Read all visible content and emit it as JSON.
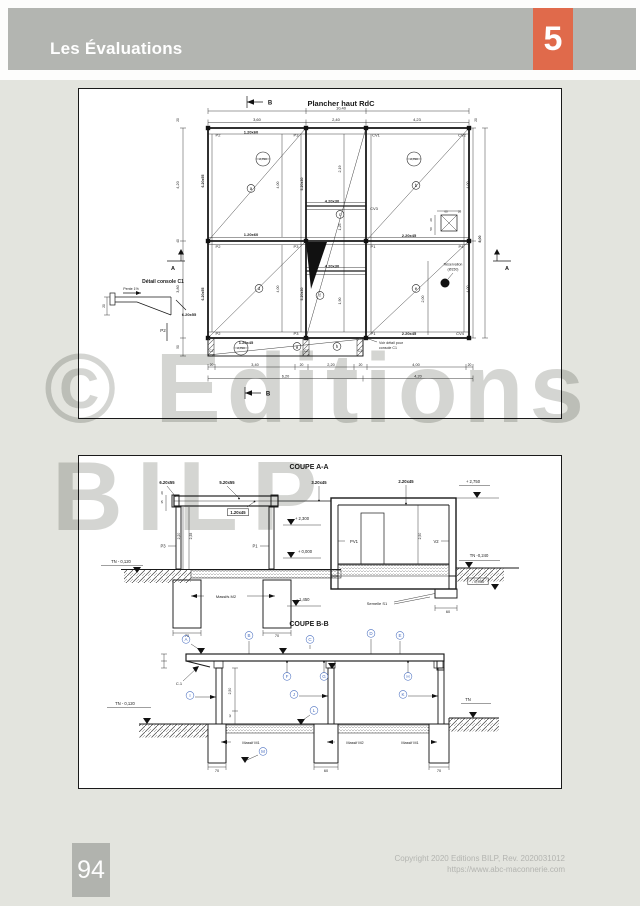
{
  "header": {
    "title": "Les Évaluations",
    "chapter": "5"
  },
  "watermark": {
    "line1": "© Editions",
    "line2": "BILP"
  },
  "footer": {
    "page_number": "94",
    "copyright_line1": "Copyright 2020 Editions BILP, Rev. 2020031012",
    "copyright_line2": "https://www.abc-maconnerie.com"
  },
  "colors": {
    "header_bar": "#b3b5b1",
    "chapter_orange": "#e06a4b",
    "page_bg": "#e3e4de",
    "panel_bg": "#ffffff",
    "line": "#1a1a1a",
    "callout_blue": "#4a6fc0",
    "watermark_gray": "#c6c7c3"
  },
  "plan": {
    "labels": [
      {
        "t": "Plancher haut RdC",
        "x": 262,
        "y": 17,
        "fs": 7.5,
        "b": 1
      },
      {
        "t": "B",
        "x": 191,
        "y": 15.5,
        "fs": 6,
        "b": 1
      },
      {
        "t": "10,40",
        "x": 262,
        "y": 20.5,
        "fs": 4
      },
      {
        "t": "3,60",
        "x": 178,
        "y": 32,
        "fs": 4
      },
      {
        "t": "2,40",
        "x": 257,
        "y": 32,
        "fs": 4
      },
      {
        "t": "4,23",
        "x": 338,
        "y": 32,
        "fs": 4
      },
      {
        "t": "20",
        "x": 100,
        "y": 31,
        "rot": -90,
        "fs": 3.2
      },
      {
        "t": "20",
        "x": 398,
        "y": 31,
        "rot": -90,
        "fs": 3.2
      },
      {
        "t": "4,20",
        "x": 100,
        "y": 96,
        "rot": -90,
        "fs": 3.8
      },
      {
        "t": "40",
        "x": 100,
        "y": 152,
        "rot": -90,
        "fs": 3.2
      },
      {
        "t": "3,80",
        "x": 100,
        "y": 200,
        "rot": -90,
        "fs": 3.8
      },
      {
        "t": "50",
        "x": 100,
        "y": 258,
        "rot": -90,
        "fs": 3.2
      },
      {
        "t": "6.20x55",
        "x": 125,
        "y": 92,
        "rot": -90,
        "fs": 3.6,
        "b": 1
      },
      {
        "t": "6.20x55",
        "x": 125,
        "y": 205,
        "rot": -90,
        "fs": 3.6,
        "b": 1
      },
      {
        "t": "5.20x30",
        "x": 224,
        "y": 95,
        "rot": -90,
        "fs": 3.6,
        "b": 1
      },
      {
        "t": "5.20x30",
        "x": 224,
        "y": 205,
        "rot": -90,
        "fs": 3.6,
        "b": 1
      },
      {
        "t": "P2",
        "x": 139,
        "y": 47.5,
        "fs": 4
      },
      {
        "t": "P3",
        "x": 217,
        "y": 47.5,
        "fs": 4
      },
      {
        "t": "CV1",
        "x": 297,
        "y": 47.5,
        "fs": 4
      },
      {
        "t": "CV2",
        "x": 383,
        "y": 47.5,
        "fs": 4
      },
      {
        "t": "1.20x60",
        "x": 172,
        "y": 44.5,
        "fs": 4,
        "b": 1
      },
      {
        "t": "1.20x60",
        "x": 172,
        "y": 147,
        "fs": 4,
        "b": 1
      },
      {
        "t": "1.20x45",
        "x": 167,
        "y": 255,
        "fs": 4,
        "b": 1
      },
      {
        "t": "P2",
        "x": 139,
        "y": 159,
        "fs": 4
      },
      {
        "t": "P3",
        "x": 217,
        "y": 159,
        "fs": 4
      },
      {
        "t": "P1",
        "x": 294,
        "y": 159,
        "fs": 4
      },
      {
        "t": "P4",
        "x": 382,
        "y": 159,
        "fs": 4
      },
      {
        "t": "P2",
        "x": 139,
        "y": 246,
        "fs": 4
      },
      {
        "t": "P3",
        "x": 217,
        "y": 246,
        "fs": 4
      },
      {
        "t": "P1",
        "x": 294,
        "y": 246,
        "fs": 4
      },
      {
        "t": "CV4",
        "x": 381,
        "y": 246,
        "fs": 4
      },
      {
        "t": "2.20x45",
        "x": 330,
        "y": 148,
        "fs": 4,
        "b": 1
      },
      {
        "t": "2.20x45",
        "x": 330,
        "y": 246,
        "fs": 4,
        "b": 1
      },
      {
        "t": "4.20x30",
        "x": 253,
        "y": 113.5,
        "fs": 4,
        "b": 1
      },
      {
        "t": "4.20x30",
        "x": 253,
        "y": 178.5,
        "fs": 4,
        "b": 1
      },
      {
        "t": "CV3",
        "x": 295,
        "y": 121,
        "fs": 4
      },
      {
        "t": "2,19",
        "x": 262,
        "y": 80,
        "rot": -90,
        "fs": 3.6
      },
      {
        "t": "1,25",
        "x": 262,
        "y": 138,
        "rot": -90,
        "fs": 3.6
      },
      {
        "t": "1,90",
        "x": 262,
        "y": 212,
        "rot": -90,
        "fs": 3.6
      },
      {
        "t": "4,00",
        "x": 200,
        "y": 96,
        "rot": -90,
        "fs": 3.6
      },
      {
        "t": "4,00",
        "x": 200,
        "y": 200,
        "rot": -90,
        "fs": 3.6
      },
      {
        "t": "4,00",
        "x": 390,
        "y": 96,
        "rot": -90,
        "fs": 3.6
      },
      {
        "t": "4,00",
        "x": 390,
        "y": 200,
        "rot": -90,
        "fs": 3.6
      },
      {
        "t": "8,00",
        "x": 402,
        "y": 150,
        "rot": -90,
        "fs": 3.6,
        "b": 1
      },
      {
        "t": "2,00",
        "x": 345,
        "y": 210,
        "rot": -90,
        "fs": 3.6
      },
      {
        "t": "a",
        "x": 172,
        "y": 101,
        "circ": 1
      },
      {
        "t": "b",
        "x": 337,
        "y": 98,
        "circ": 1
      },
      {
        "t": "c",
        "x": 261,
        "y": 127,
        "circ": 1
      },
      {
        "t": "d",
        "x": 180,
        "y": 201,
        "circ": 1
      },
      {
        "t": "e",
        "x": 337,
        "y": 201,
        "circ": 1
      },
      {
        "t": "f",
        "x": 241,
        "y": 208,
        "circ": 1
      },
      {
        "t": "g",
        "x": 218,
        "y": 259,
        "circ": 1
      },
      {
        "t": "h",
        "x": 258,
        "y": 259,
        "circ": 1
      },
      {
        "t": "2,790",
        "x": 184,
        "y": 71,
        "circ": 1,
        "r": 7,
        "fs": 3
      },
      {
        "t": "2,790",
        "x": 335,
        "y": 71,
        "circ": 1,
        "r": 7,
        "fs": 3
      },
      {
        "t": "2,790",
        "x": 162,
        "y": 260,
        "circ": 1,
        "r": 7,
        "fs": 3
      },
      {
        "t": "60",
        "x": 367,
        "y": 123.5,
        "fs": 3
      },
      {
        "t": "20",
        "x": 380.5,
        "y": 123.5,
        "fs": 3
      },
      {
        "t": "20",
        "x": 353,
        "y": 131,
        "rot": -90,
        "fs": 3
      },
      {
        "t": "50",
        "x": 353,
        "y": 140,
        "rot": -90,
        "fs": 3
      },
      {
        "t": "Réservation",
        "x": 374,
        "y": 176.5,
        "fs": 3.5
      },
      {
        "t": "(Ø150)",
        "x": 374,
        "y": 181.5,
        "fs": 3.5
      },
      {
        "t": "A",
        "x": 94,
        "y": 181,
        "fs": 5.5,
        "b": 1
      },
      {
        "t": "A",
        "x": 428,
        "y": 181,
        "fs": 5.5,
        "b": 1
      },
      {
        "t": "Détail console C1",
        "x": 84,
        "y": 194,
        "fs": 5,
        "b": 1
      },
      {
        "t": "Pente 1%",
        "x": 52,
        "y": 201,
        "fs": 3.6
      },
      {
        "t": "20",
        "x": 26,
        "y": 217,
        "rot": -90,
        "fs": 3.2
      },
      {
        "t": "6.20x55",
        "x": 110,
        "y": 227,
        "fs": 4,
        "b": 1
      },
      {
        "t": "P2",
        "x": 84,
        "y": 243,
        "fs": 4.5
      },
      {
        "t": "C1",
        "x": 132,
        "y": 263,
        "fs": 3.2
      },
      {
        "t": "C2",
        "x": 227,
        "y": 263,
        "fs": 3.2
      },
      {
        "t": "C3",
        "x": 281,
        "y": 263,
        "fs": 3.2
      },
      {
        "t": "Voir détail pour",
        "x": 300,
        "y": 255,
        "fs": 3.6,
        "a": "s"
      },
      {
        "t": "console C1",
        "x": 300,
        "y": 260,
        "fs": 3.6,
        "a": "s"
      },
      {
        "t": "20",
        "x": 132.5,
        "y": 277,
        "fs": 3.4
      },
      {
        "t": "3,40",
        "x": 176,
        "y": 277,
        "fs": 3.8
      },
      {
        "t": "20",
        "x": 222.5,
        "y": 277,
        "fs": 3.4
      },
      {
        "t": "2,20",
        "x": 252,
        "y": 277,
        "fs": 3.8
      },
      {
        "t": "20",
        "x": 281.5,
        "y": 277,
        "fs": 3.4
      },
      {
        "t": "4,00",
        "x": 337,
        "y": 277,
        "fs": 3.8
      },
      {
        "t": "20",
        "x": 390.5,
        "y": 277,
        "fs": 3.4
      },
      {
        "t": "6,20",
        "x": 206.5,
        "y": 288.5,
        "fs": 3.8
      },
      {
        "t": "4,20",
        "x": 339,
        "y": 288.5,
        "fs": 3.8
      },
      {
        "t": "B",
        "x": 189,
        "y": 306.5,
        "fs": 6,
        "b": 1
      }
    ]
  },
  "coupe_a": {
    "labels": [
      {
        "t": "COUPE A-A",
        "x": 230,
        "y": 13,
        "fs": 7,
        "b": 1
      },
      {
        "t": "6.20x55",
        "x": 88,
        "y": 28,
        "fs": 4.2,
        "b": 1
      },
      {
        "t": "5.20x55",
        "x": 148,
        "y": 28,
        "fs": 4.2,
        "b": 1
      },
      {
        "t": "3.20x45",
        "x": 240,
        "y": 28,
        "fs": 4.2,
        "b": 1
      },
      {
        "t": "2.20x45",
        "x": 327,
        "y": 27,
        "fs": 4.2,
        "b": 1
      },
      {
        "t": "+ 2,750",
        "x": 394,
        "y": 27,
        "fs": 4.2
      },
      {
        "t": "1.20x45",
        "x": 159,
        "y": 58,
        "fs": 4.2,
        "b": 1,
        "box": 1
      },
      {
        "t": "+ 2,300",
        "x": 223,
        "y": 64,
        "fs": 4.2
      },
      {
        "t": "20",
        "x": 84,
        "y": 37,
        "rot": -90,
        "fs": 3
      },
      {
        "t": "35",
        "x": 84,
        "y": 46,
        "rot": -90,
        "fs": 3
      },
      {
        "t": "2,20",
        "x": 101,
        "y": 80,
        "rot": -90,
        "fs": 3.4
      },
      {
        "t": "2,35",
        "x": 113,
        "y": 80,
        "rot": -90,
        "fs": 3.4
      },
      {
        "t": "P3",
        "x": 84,
        "y": 91.5,
        "fs": 4.2
      },
      {
        "t": "P1",
        "x": 176,
        "y": 91.5,
        "fs": 4.2
      },
      {
        "t": "PV1",
        "x": 275,
        "y": 87,
        "fs": 4.2
      },
      {
        "t": "V2",
        "x": 357,
        "y": 87,
        "fs": 4.2
      },
      {
        "t": "2,50",
        "x": 342,
        "y": 80,
        "rot": -90,
        "fs": 3.4
      },
      {
        "t": "TN - 0,120",
        "x": 42,
        "y": 107,
        "fs": 4.2
      },
      {
        "t": "+ 0,000",
        "x": 226,
        "y": 97,
        "fs": 4.2
      },
      {
        "t": "Massifs M2",
        "x": 147,
        "y": 142,
        "fs": 4
      },
      {
        "t": "- 1,450",
        "x": 224,
        "y": 145,
        "fs": 4.2
      },
      {
        "t": "70",
        "x": 108,
        "y": 181,
        "fs": 3.8
      },
      {
        "t": "70",
        "x": 198,
        "y": 181,
        "fs": 3.8
      },
      {
        "t": "TN -0,240",
        "x": 400,
        "y": 101,
        "fs": 4.2
      },
      {
        "t": "- 0,950",
        "x": 399,
        "y": 127,
        "fs": 4,
        "box": 1
      },
      {
        "t": "Semelle S1",
        "x": 298,
        "y": 149,
        "fs": 4
      },
      {
        "t": "60",
        "x": 369,
        "y": 157,
        "fs": 3.8
      }
    ]
  },
  "coupe_b": {
    "labels": [
      {
        "t": "COUPE B-B",
        "x": 230,
        "y": 170,
        "fs": 7,
        "b": 1
      },
      {
        "t": "A",
        "x": 107,
        "y": 185,
        "circ": 1,
        "col": "b"
      },
      {
        "t": "B",
        "x": 170,
        "y": 181,
        "circ": 1,
        "col": "b"
      },
      {
        "t": "C",
        "x": 231,
        "y": 185,
        "circ": 1,
        "col": "b"
      },
      {
        "t": "D",
        "x": 292,
        "y": 179,
        "circ": 1,
        "col": "b"
      },
      {
        "t": "E",
        "x": 321,
        "y": 181,
        "circ": 1,
        "col": "b"
      },
      {
        "t": "F",
        "x": 208,
        "y": 222,
        "circ": 1,
        "col": "b"
      },
      {
        "t": "G",
        "x": 245,
        "y": 222,
        "circ": 1,
        "col": "b"
      },
      {
        "t": "H",
        "x": 329,
        "y": 222,
        "circ": 1,
        "col": "b"
      },
      {
        "t": "I",
        "x": 111,
        "y": 241,
        "circ": 1,
        "col": "b"
      },
      {
        "t": "J",
        "x": 215,
        "y": 240,
        "circ": 1,
        "col": "b"
      },
      {
        "t": "K",
        "x": 324,
        "y": 240,
        "circ": 1,
        "col": "b"
      },
      {
        "t": "L",
        "x": 235,
        "y": 256,
        "circ": 1,
        "col": "b"
      },
      {
        "t": "M",
        "x": 184,
        "y": 297,
        "circ": 1,
        "col": "b"
      },
      {
        "t": "C.1",
        "x": 100,
        "y": 229,
        "fs": 4
      },
      {
        "t": "TN - 0,120",
        "x": 46,
        "y": 249,
        "fs": 4.2
      },
      {
        "t": "TN",
        "x": 389,
        "y": 245,
        "fs": 4.2
      },
      {
        "t": "2,50",
        "x": 152,
        "y": 235,
        "rot": -90,
        "fs": 3.4
      },
      {
        "t": "12",
        "x": 152,
        "y": 260,
        "rot": -90,
        "fs": 3
      },
      {
        "t": "Massif M1",
        "x": 172,
        "y": 288,
        "fs": 3.8
      },
      {
        "t": "Massif M2",
        "x": 276,
        "y": 288,
        "fs": 3.8
      },
      {
        "t": "Massif M1",
        "x": 331,
        "y": 288,
        "fs": 3.8
      },
      {
        "t": "70",
        "x": 138,
        "y": 316,
        "fs": 3.8
      },
      {
        "t": "60",
        "x": 247,
        "y": 316,
        "fs": 3.8
      },
      {
        "t": "70",
        "x": 360,
        "y": 316,
        "fs": 3.8
      }
    ]
  }
}
